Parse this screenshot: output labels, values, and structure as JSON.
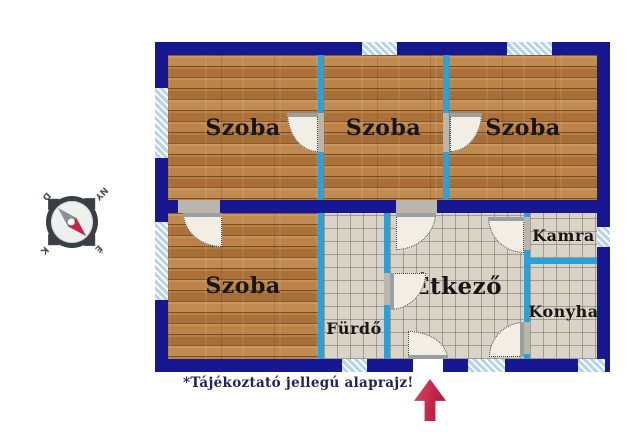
{
  "note": "*Tájékoztató jellegú alaprajz!",
  "rooms": {
    "szoba1": "Szoba",
    "szoba2": "Szoba",
    "szoba3": "Szoba",
    "szoba4": "Szoba",
    "furdo": "Fürdő",
    "etkezo": "Étkező",
    "kamra": "Kamra",
    "konyha": "Konyha"
  },
  "compass": {
    "north": "É",
    "east": "K",
    "south": "D",
    "west": "NY"
  },
  "colors": {
    "wall_outer": "#171792",
    "wall_inner": "#2aa2d8",
    "window_fill": "#b6d3e8",
    "wood_floor": "#b67e44",
    "tile_floor": "#dad4c8",
    "door_fill": "#f2eee5",
    "arrow": "#c22549",
    "needle_north": "#c5244b",
    "needle_south": "#8d9296"
  }
}
